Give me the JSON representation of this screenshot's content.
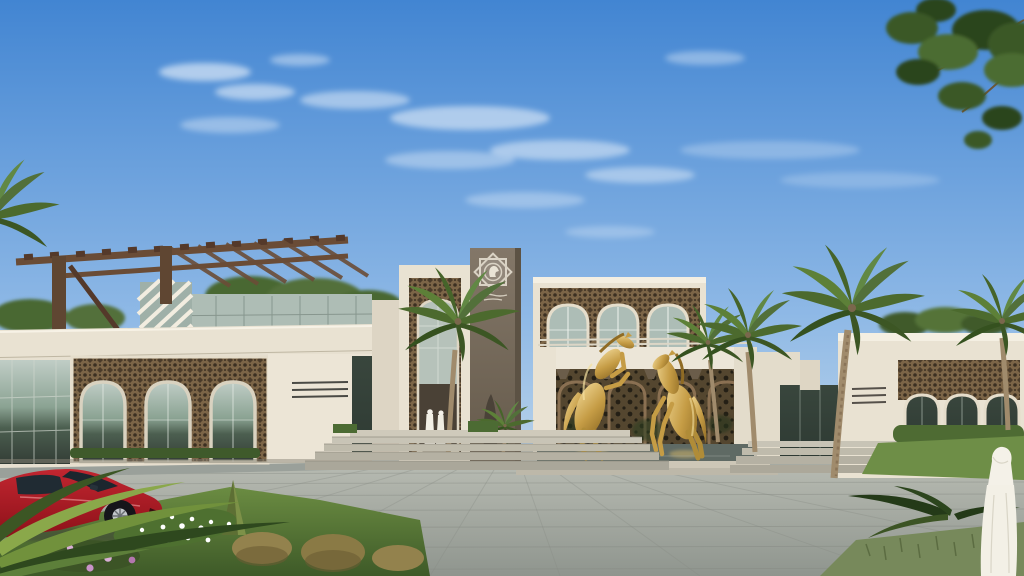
{
  "image": {
    "title": "Daytime exterior rendering of a contemporary Arabian villa with golden horse statues",
    "type": "architectural exterior rendering"
  },
  "palette": {
    "sky_top": "#4285d2",
    "sky_mid": "#8fb9e6",
    "sky_horizon": "#dbe7ec",
    "cloud_white": "#ffffff",
    "stone_cream": "#e9e2d2",
    "stone_light": "#f4efe2",
    "stone_shadow": "#cfc7b3",
    "taupe_top": "#837768",
    "taupe_bottom": "#655a4b",
    "wood_brown": "#6a4c36",
    "wood_dark": "#54392a",
    "bronze": "#7c6547",
    "bronze_dark": "#3c3022",
    "screen_dark": "#54462f",
    "screen_hole": "#241f15",
    "glass_sky": "#c0cdc6",
    "glass_tree": "#4c5f50",
    "glass_deep": "#2e3a33",
    "gold_light": "#f0d794",
    "gold_mid": "#c59c45",
    "gold_dark": "#8f6b24",
    "water_teal": "#5f6a64",
    "paving_light": "#bcbfb6",
    "paving_dark": "#8f958e",
    "grass_light": "#6b8c42",
    "grass_dark": "#3e5a28",
    "hedge_green": "#4e6b33",
    "palm_green": "#5a7c36",
    "palm_dark": "#3c5624",
    "trunk_tan": "#a08b6c",
    "car_red": "#c22630",
    "car_red_dark": "#8c1119",
    "window_tint": "#1c262e",
    "robe_white": "#f3f0e6",
    "flower_pink": "#c993c9",
    "flower_white": "#ffffff",
    "shrub_gold": "#93824d",
    "foliage_dark": "#2c451d"
  },
  "scene": {
    "sky": "clear blue sky fading to pale horizon with thin wispy clouds",
    "left_wing": "two-storey wing with rooftop timber pergola, cream stone fascia, glass curtain walls and three arched mashrabiya windows",
    "entrance_portal": "tall cream portal filled with geometric bronze lattice over a recessed doorway",
    "emblem_tower": "dark taupe tower bearing an eight-pointed star emblem with a horse-head motif and calligraphic marks",
    "upper_gallery": "upper block with three lattice-crowned arched windows",
    "horse_pavilion": "white pavilion frame with pergola slats and corbels, bronze lattice screens and a reflecting pool",
    "statues": "two golden rearing horse statues standing in the reflecting pool",
    "right_wing": "single-storey wing with three arched lattice windows behind a clipped hedge and lawn",
    "vegetation": "date palms, overhanging tree at top right, white and pink flower beds, cone topiary, dry golden shrubs, fan fronds",
    "vehicle": "red sports coupe parked at the lower left",
    "people": "two figures in white robes at the entrance steps; a man in a white thobe and ghutra walking in the right foreground",
    "ground": "large grey stone paving with perspective joint lines and wide entrance steps"
  }
}
